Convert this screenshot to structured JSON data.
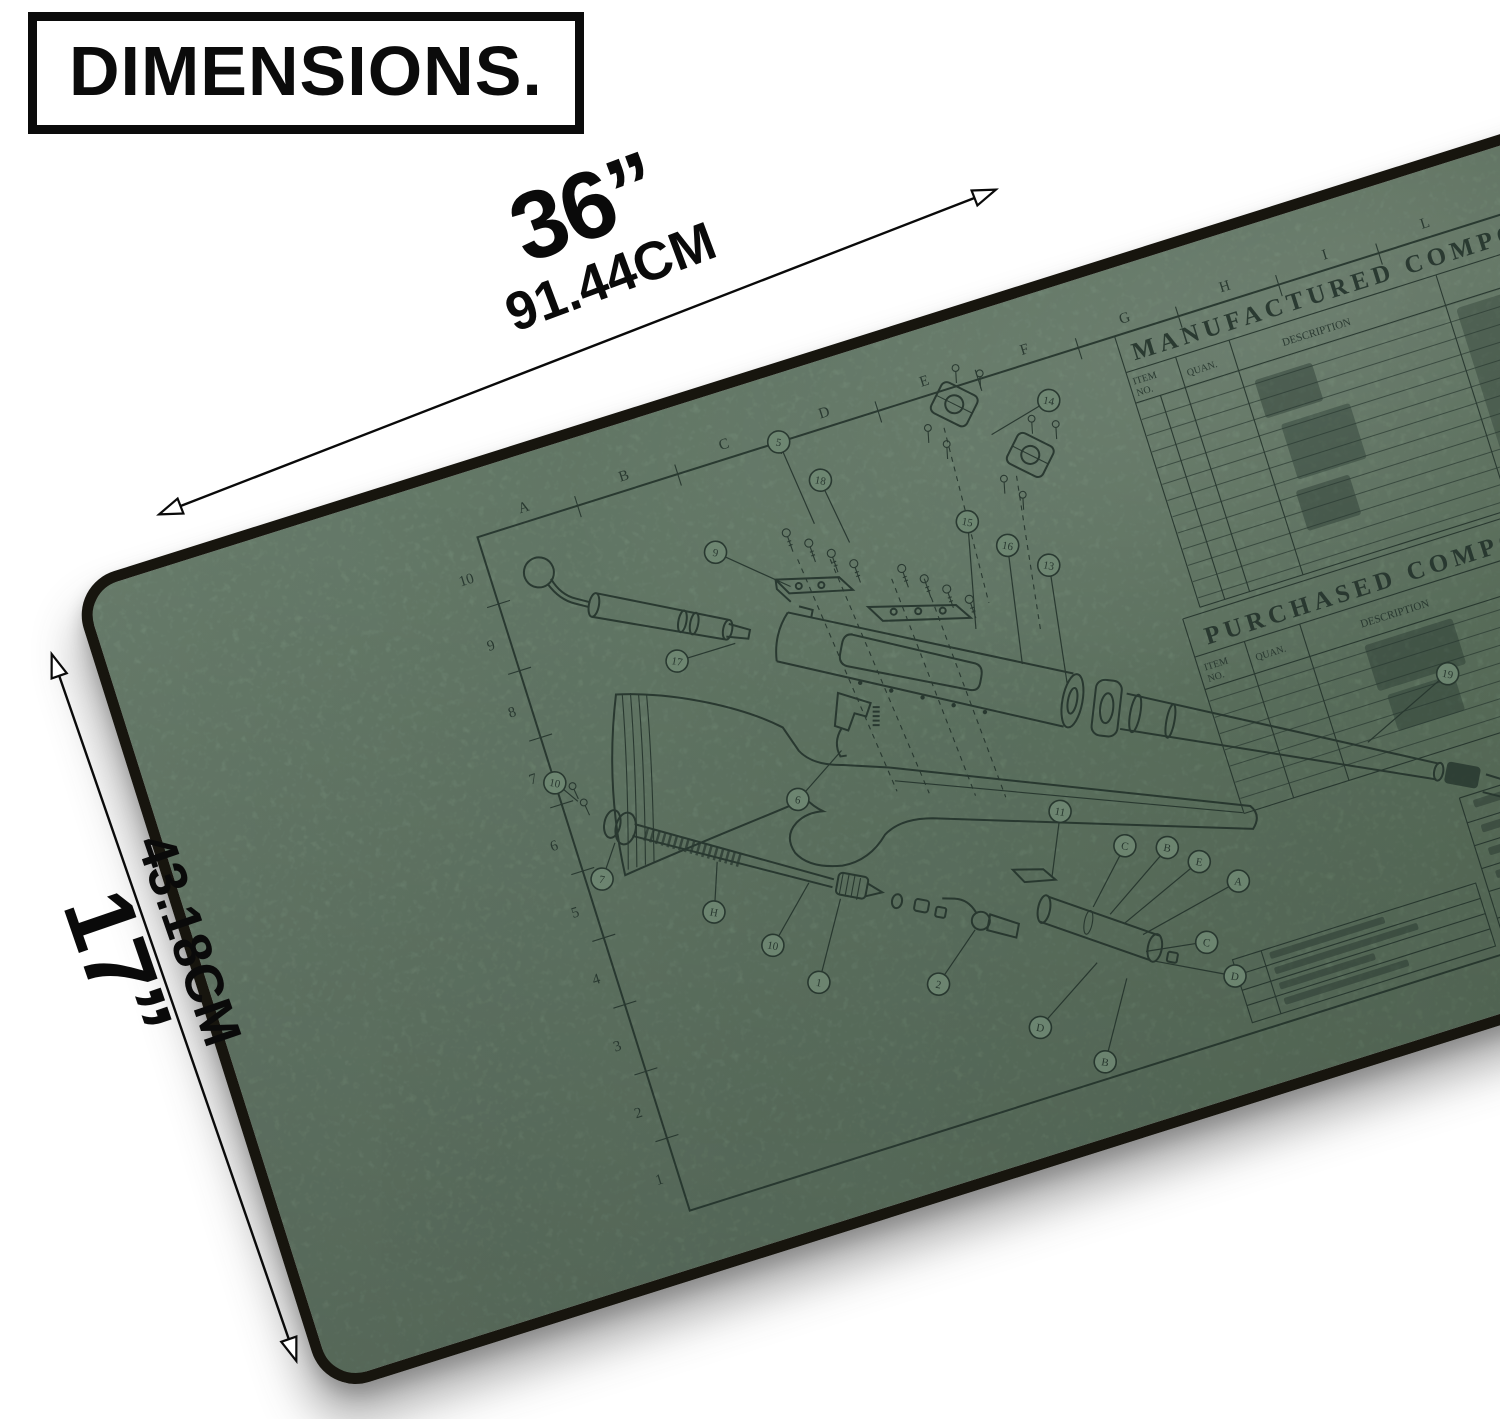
{
  "theme": {
    "page_bg": "#ffffff",
    "mat_green": "#6f8873",
    "mat_edge": "#17150e",
    "ink": "#22312a",
    "label_black": "#0a0a0a"
  },
  "header": {
    "title": "DIMENSIONS."
  },
  "dimensions": {
    "width": {
      "inches": "36”",
      "metric": "91.44CM"
    },
    "height": {
      "inches": "17”",
      "metric": "43.18CM"
    }
  },
  "mat": {
    "blueprint": {
      "grid_letters": [
        "A",
        "B",
        "C",
        "D",
        "E",
        "F",
        "G",
        "H",
        "I",
        "L"
      ],
      "ruler_numbers": [
        "10",
        "9",
        "8",
        "7",
        "6",
        "5",
        "4",
        "3",
        "2",
        "1"
      ],
      "manufactured_table": {
        "title": "MANUFACTURED COMPONENTS",
        "col_item_1": "ITEM",
        "col_item_2": "NO.",
        "col_quan": "QUAN.",
        "col_description": "DESCRIPTION",
        "col_part_number": "PART NUMBER",
        "col_rev": "REV"
      },
      "purchased_table": {
        "title": "PURCHASED COMPONENTS",
        "col_item_1": "ITEM",
        "col_item_2": "NO.",
        "col_quan": "QUAN.",
        "col_description": "DESCRIPTION",
        "col_material_1": "MATERIAL",
        "col_material_2": "SPECIFICATION"
      },
      "title_block": {
        "note": "DO NOT SCALE"
      },
      "callouts": [
        "9",
        "5",
        "18",
        "14",
        "15",
        "16",
        "13",
        "19",
        "17",
        "6",
        "10",
        "7",
        "H",
        "10",
        "1",
        "2",
        "D",
        "B",
        "11",
        "C",
        "B",
        "E",
        "A",
        "C",
        "D"
      ]
    }
  }
}
